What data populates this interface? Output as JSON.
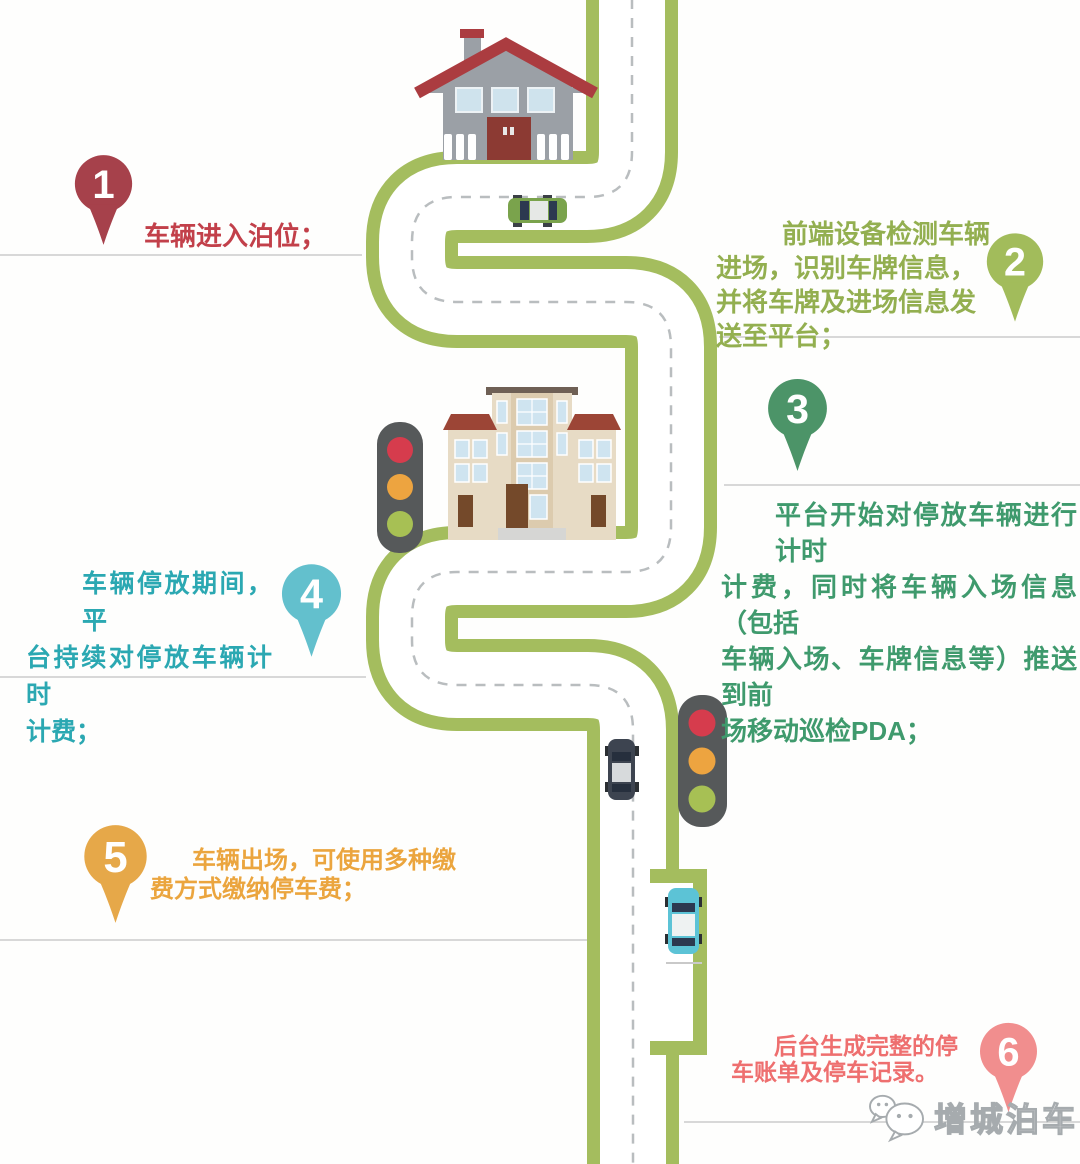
{
  "title": "智慧泊车流程示意图",
  "steps": [
    {
      "number": "1",
      "pin_color": "#A6414B",
      "text_color": "#C2404A",
      "lines": [
        "车辆进入泊位；"
      ]
    },
    {
      "number": "2",
      "pin_color": "#A2BC5B",
      "text_color": "#93AF50",
      "lines": [
        "前端设备检测车辆",
        "进场，识别车牌信息，",
        "并将车牌及进场信息发",
        "送至平台；"
      ]
    },
    {
      "number": "3",
      "pin_color": "#4C9468",
      "text_color": "#3F9A6D",
      "lines": [
        "平台开始对停放车辆进行计时",
        "计费，同时将车辆入场信息（包括",
        "车辆入场、车牌信息等）推送到前",
        "场移动巡检PDA；"
      ]
    },
    {
      "number": "4",
      "pin_color": "#63C0CD",
      "text_color": "#2BA8B2",
      "lines": [
        "车辆停放期间，平",
        "台持续对停放车辆计时",
        "计费；"
      ]
    },
    {
      "number": "5",
      "pin_color": "#E6A849",
      "text_color": "#EBA53E",
      "lines": [
        "车辆出场，可使用多种缴",
        "费方式缴纳停车费；"
      ]
    },
    {
      "number": "6",
      "pin_color": "#F18E8E",
      "text_color": "#EE6F6F",
      "lines": [
        "后台生成完整的停",
        "车账单及停车记录。"
      ]
    }
  ],
  "watermark": {
    "text": "增城泊车",
    "icon": "wechat-icon"
  },
  "colors": {
    "road_border": "#A4BD5E",
    "road_lane": "#FFFFFF",
    "center_dash": "#B9BDBF",
    "separator": "#CBCCCC",
    "traffic_red": "#D63C4D",
    "traffic_amber": "#EDA440",
    "traffic_green": "#A7C054",
    "house_roof": "#AB3C40",
    "house_wall": "#9BA0A6",
    "building_wall": "#E7DBC5",
    "building_roof": "#9C4536",
    "car_green": "#7AA34C",
    "car_dark": "#3D4450",
    "car_cyan": "#5CC3D6"
  },
  "scene": {
    "house": "house-icon",
    "office_building": "office-building-icon",
    "traffic_lights": [
      "traffic-light-icon",
      "traffic-light-icon"
    ],
    "cars": [
      "green-car-top-view",
      "dark-car-top-view",
      "cyan-car-top-view"
    ],
    "road": "winding-road-with-dashed-center-line",
    "parking_bay": "roadside-parking-bay"
  }
}
